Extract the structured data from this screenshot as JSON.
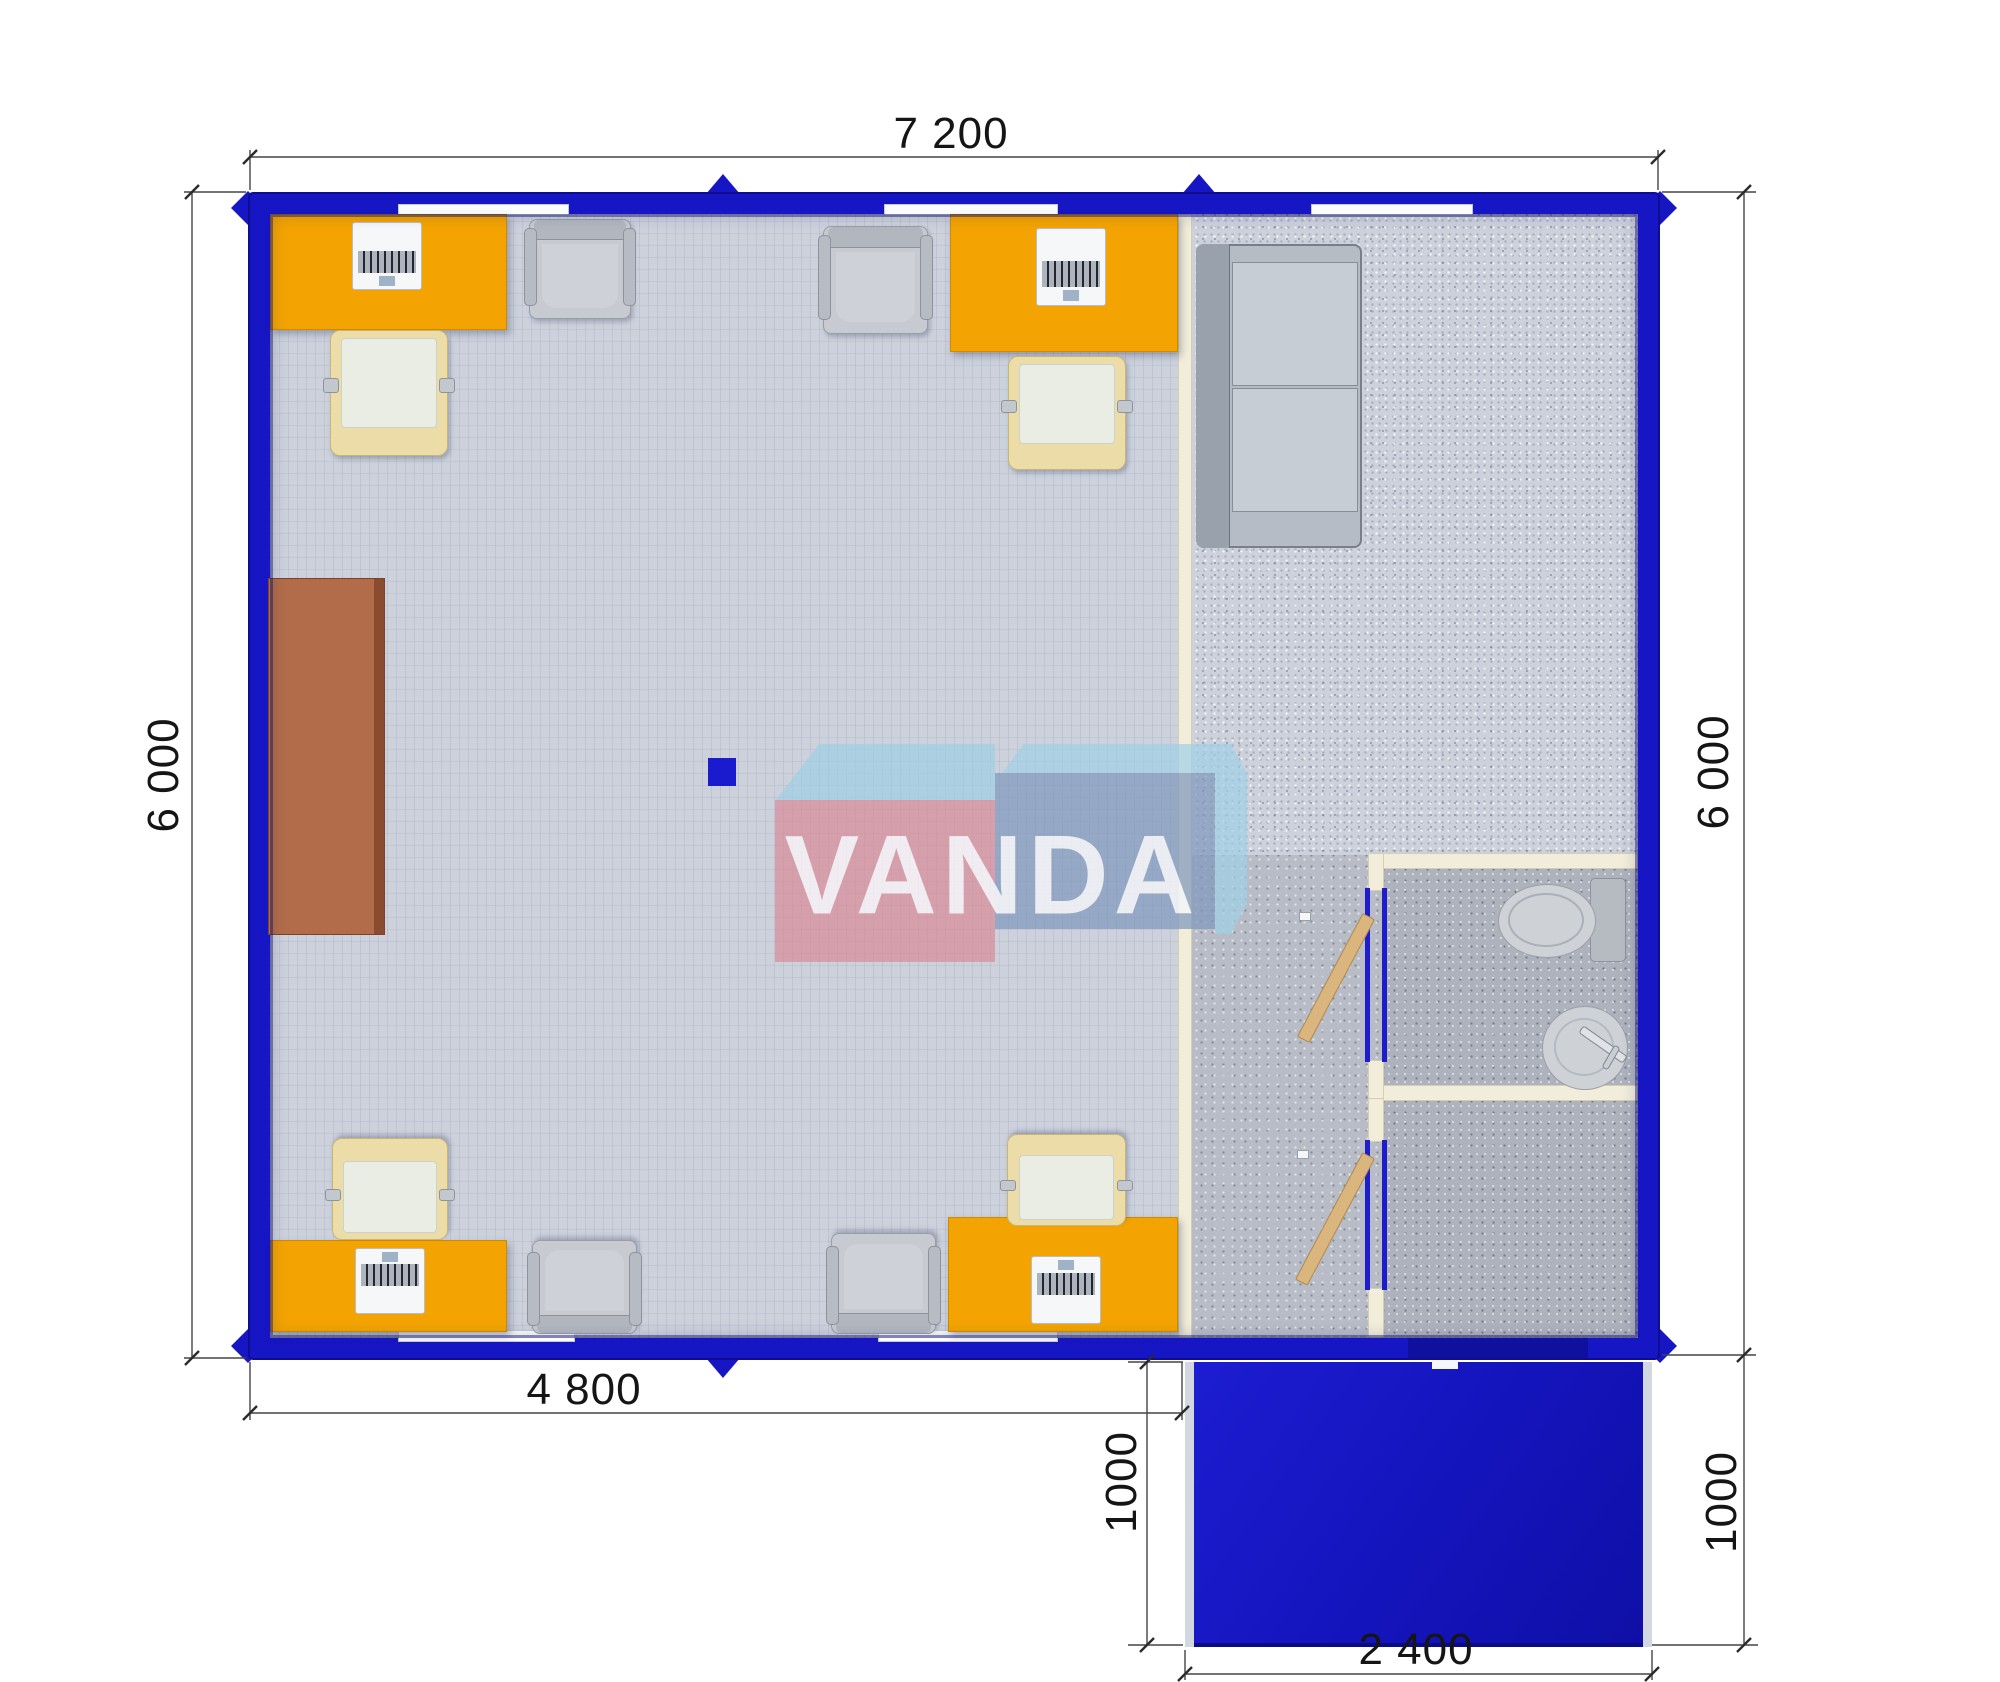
{
  "dimensions": {
    "width_total": "7 200",
    "height_left": "6 000",
    "height_right": "6 000",
    "width_main": "4 800",
    "porch_depth_left": "1000",
    "porch_depth_right": "1000",
    "porch_width": "2 400"
  },
  "watermark": {
    "text": "VANDA"
  },
  "colors": {
    "wall_blue": "#1616c4",
    "porch_blue": "#1414bc",
    "desk_orange": "#f3a402",
    "floor_light": "#ccd1dc",
    "floor_dark": "#aeb2bd",
    "partition_cream": "#f1edda",
    "cabinet_brown": "#b26c49",
    "watermark_pink": "#d98a98",
    "watermark_steel_blue": "#829cbc",
    "watermark_light_blue": "#a0d0e6"
  },
  "inventory": {
    "office_desks": 4,
    "desk_chairs": 4,
    "guest_chairs": 4,
    "sofa": 1,
    "cabinet": 1,
    "toilet": 1,
    "sink": 1,
    "interior_doors": 2,
    "exterior_door": 1,
    "windows": 5,
    "porch": 1
  }
}
